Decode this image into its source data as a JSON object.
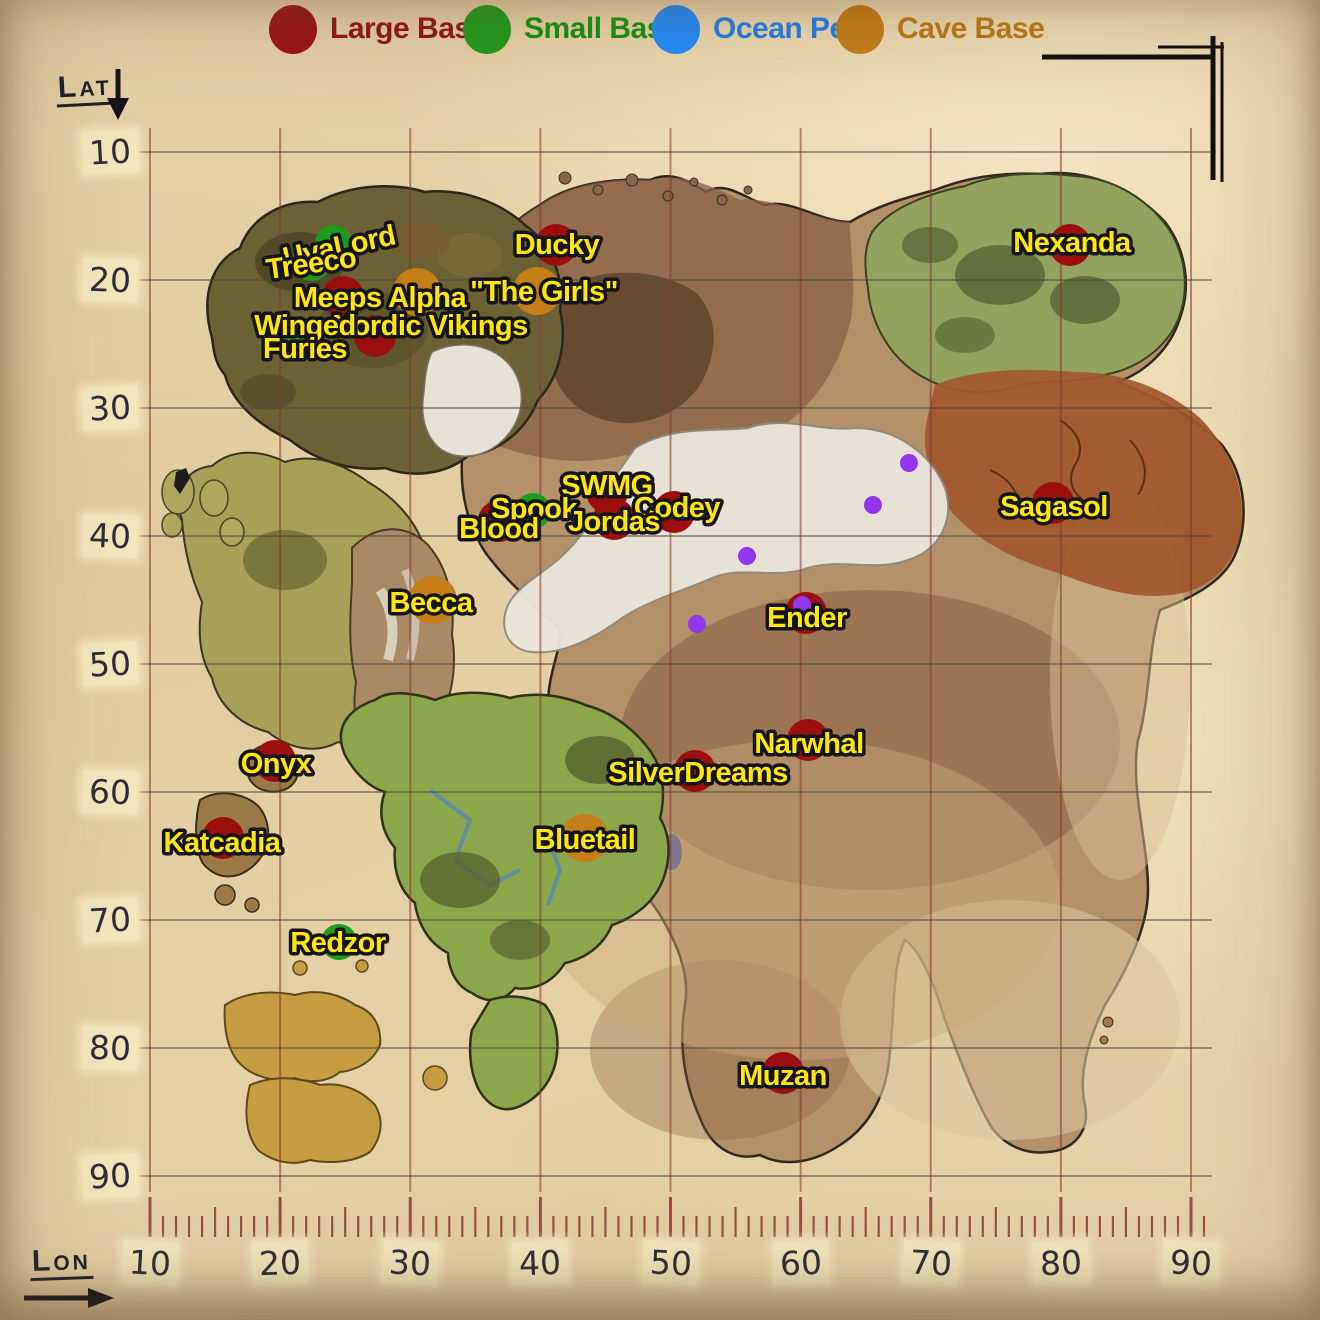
{
  "legend": {
    "items": [
      {
        "label": "Large Base",
        "color": "#9a1212",
        "text_color": "#8e1414",
        "type": "large"
      },
      {
        "label": "Small Base",
        "color": "#1d9b1d",
        "text_color": "#149114",
        "type": "small"
      },
      {
        "label": "Ocean Pen",
        "color": "#1e8cff",
        "text_color": "#1e7ef0",
        "type": "ocean"
      },
      {
        "label": "Cave Base",
        "color": "#c47e18",
        "text_color": "#bf7a15",
        "type": "cave"
      }
    ]
  },
  "axes": {
    "lat_title": "Lat",
    "lon_title": "Lon",
    "lat_ticks": [
      "10",
      "20",
      "30",
      "40",
      "50",
      "60",
      "70",
      "80",
      "90"
    ],
    "lon_ticks": [
      "10",
      "20",
      "30",
      "40",
      "50",
      "60",
      "70",
      "80",
      "90"
    ]
  },
  "colors": {
    "large": "#9b0f0f",
    "small": "#1d9b1d",
    "cave": "#c47e18",
    "ocean": "#1e8cff",
    "dot": "#9137ef",
    "label_fill": "#ffe70a",
    "label_stroke": "#141414",
    "grid_vertical": "rgba(128,56,44,0.55)",
    "grid_horizontal": "rgba(84,74,60,0.6)",
    "ruler_tick": "#8d3a33"
  },
  "markers": [
    {
      "name": "UvaLord",
      "type": "small",
      "cx": 333,
      "cy": 243,
      "lx": 339,
      "ly": 246,
      "rot": -12
    },
    {
      "name": "Treeco",
      "type": "small",
      "cx": 312,
      "cy": 263,
      "lx": 311,
      "ly": 263,
      "rot": -8
    },
    {
      "name": "Ducky",
      "type": "large",
      "cx": 556,
      "cy": 245,
      "lx": 557,
      "ly": 244
    },
    {
      "name": "Meeps Alpha",
      "type": "large",
      "cx": 343,
      "cy": 297,
      "lx": 380,
      "ly": 297
    },
    {
      "name": "",
      "type": "cave",
      "cx": 417,
      "cy": 292
    },
    {
      "name": "\"The Girls\"",
      "type": "cave",
      "cx": 537,
      "cy": 291,
      "lx": 544,
      "ly": 291
    },
    {
      "name": "Nordic Vikings",
      "type": "large",
      "cx": 375,
      "cy": 336,
      "lx": 430,
      "ly": 325
    },
    {
      "name": "Winged Furies",
      "type": "small",
      "cx": 297,
      "cy": 342,
      "lx": 305,
      "ly": 331,
      "lines": [
        "Winged",
        "Furies"
      ]
    },
    {
      "name": "Nexanda",
      "type": "large",
      "cx": 1070,
      "cy": 245,
      "lx": 1072,
      "ly": 242
    },
    {
      "name": "SWMG",
      "type": "large",
      "cx": 607,
      "cy": 492,
      "lx": 607,
      "ly": 485
    },
    {
      "name": "Spook",
      "type": "small",
      "cx": 533,
      "cy": 511,
      "lx": 534,
      "ly": 508
    },
    {
      "name": "Codey",
      "type": "large",
      "cx": 674,
      "cy": 512,
      "lx": 677,
      "ly": 507
    },
    {
      "name": "Blood",
      "type": "large",
      "cx": 499,
      "cy": 521,
      "lx": 499,
      "ly": 528
    },
    {
      "name": "Jordas",
      "type": "large",
      "cx": 614,
      "cy": 519,
      "lx": 614,
      "ly": 521
    },
    {
      "name": "Sagasol",
      "type": "large",
      "cx": 1053,
      "cy": 503,
      "lx": 1054,
      "ly": 506
    },
    {
      "name": "Becca",
      "type": "cave",
      "cx": 433,
      "cy": 600,
      "lx": 431,
      "ly": 602
    },
    {
      "name": "Ender",
      "type": "large",
      "cx": 806,
      "cy": 613,
      "lx": 807,
      "ly": 617
    },
    {
      "name": "Narwhal",
      "type": "large",
      "cx": 808,
      "cy": 740,
      "lx": 809,
      "ly": 743
    },
    {
      "name": "SilverDreams",
      "type": "large",
      "cx": 695,
      "cy": 771,
      "lx": 698,
      "ly": 772
    },
    {
      "name": "Onyx",
      "type": "large",
      "cx": 275,
      "cy": 761,
      "lx": 276,
      "ly": 763
    },
    {
      "name": "Bluetail",
      "type": "cave",
      "cx": 585,
      "cy": 838,
      "lx": 585,
      "ly": 839
    },
    {
      "name": "Katcadia",
      "type": "large",
      "cx": 223,
      "cy": 838,
      "lx": 222,
      "ly": 842
    },
    {
      "name": "Redzor",
      "type": "small",
      "cx": 339,
      "cy": 942,
      "lx": 338,
      "ly": 942
    },
    {
      "name": "Muzan",
      "type": "large",
      "cx": 783,
      "cy": 1073,
      "lx": 783,
      "ly": 1075
    }
  ],
  "purple_dots": [
    {
      "x": 909,
      "y": 463
    },
    {
      "x": 873,
      "y": 505
    },
    {
      "x": 747,
      "y": 556
    },
    {
      "x": 802,
      "y": 605
    },
    {
      "x": 697,
      "y": 624
    }
  ]
}
